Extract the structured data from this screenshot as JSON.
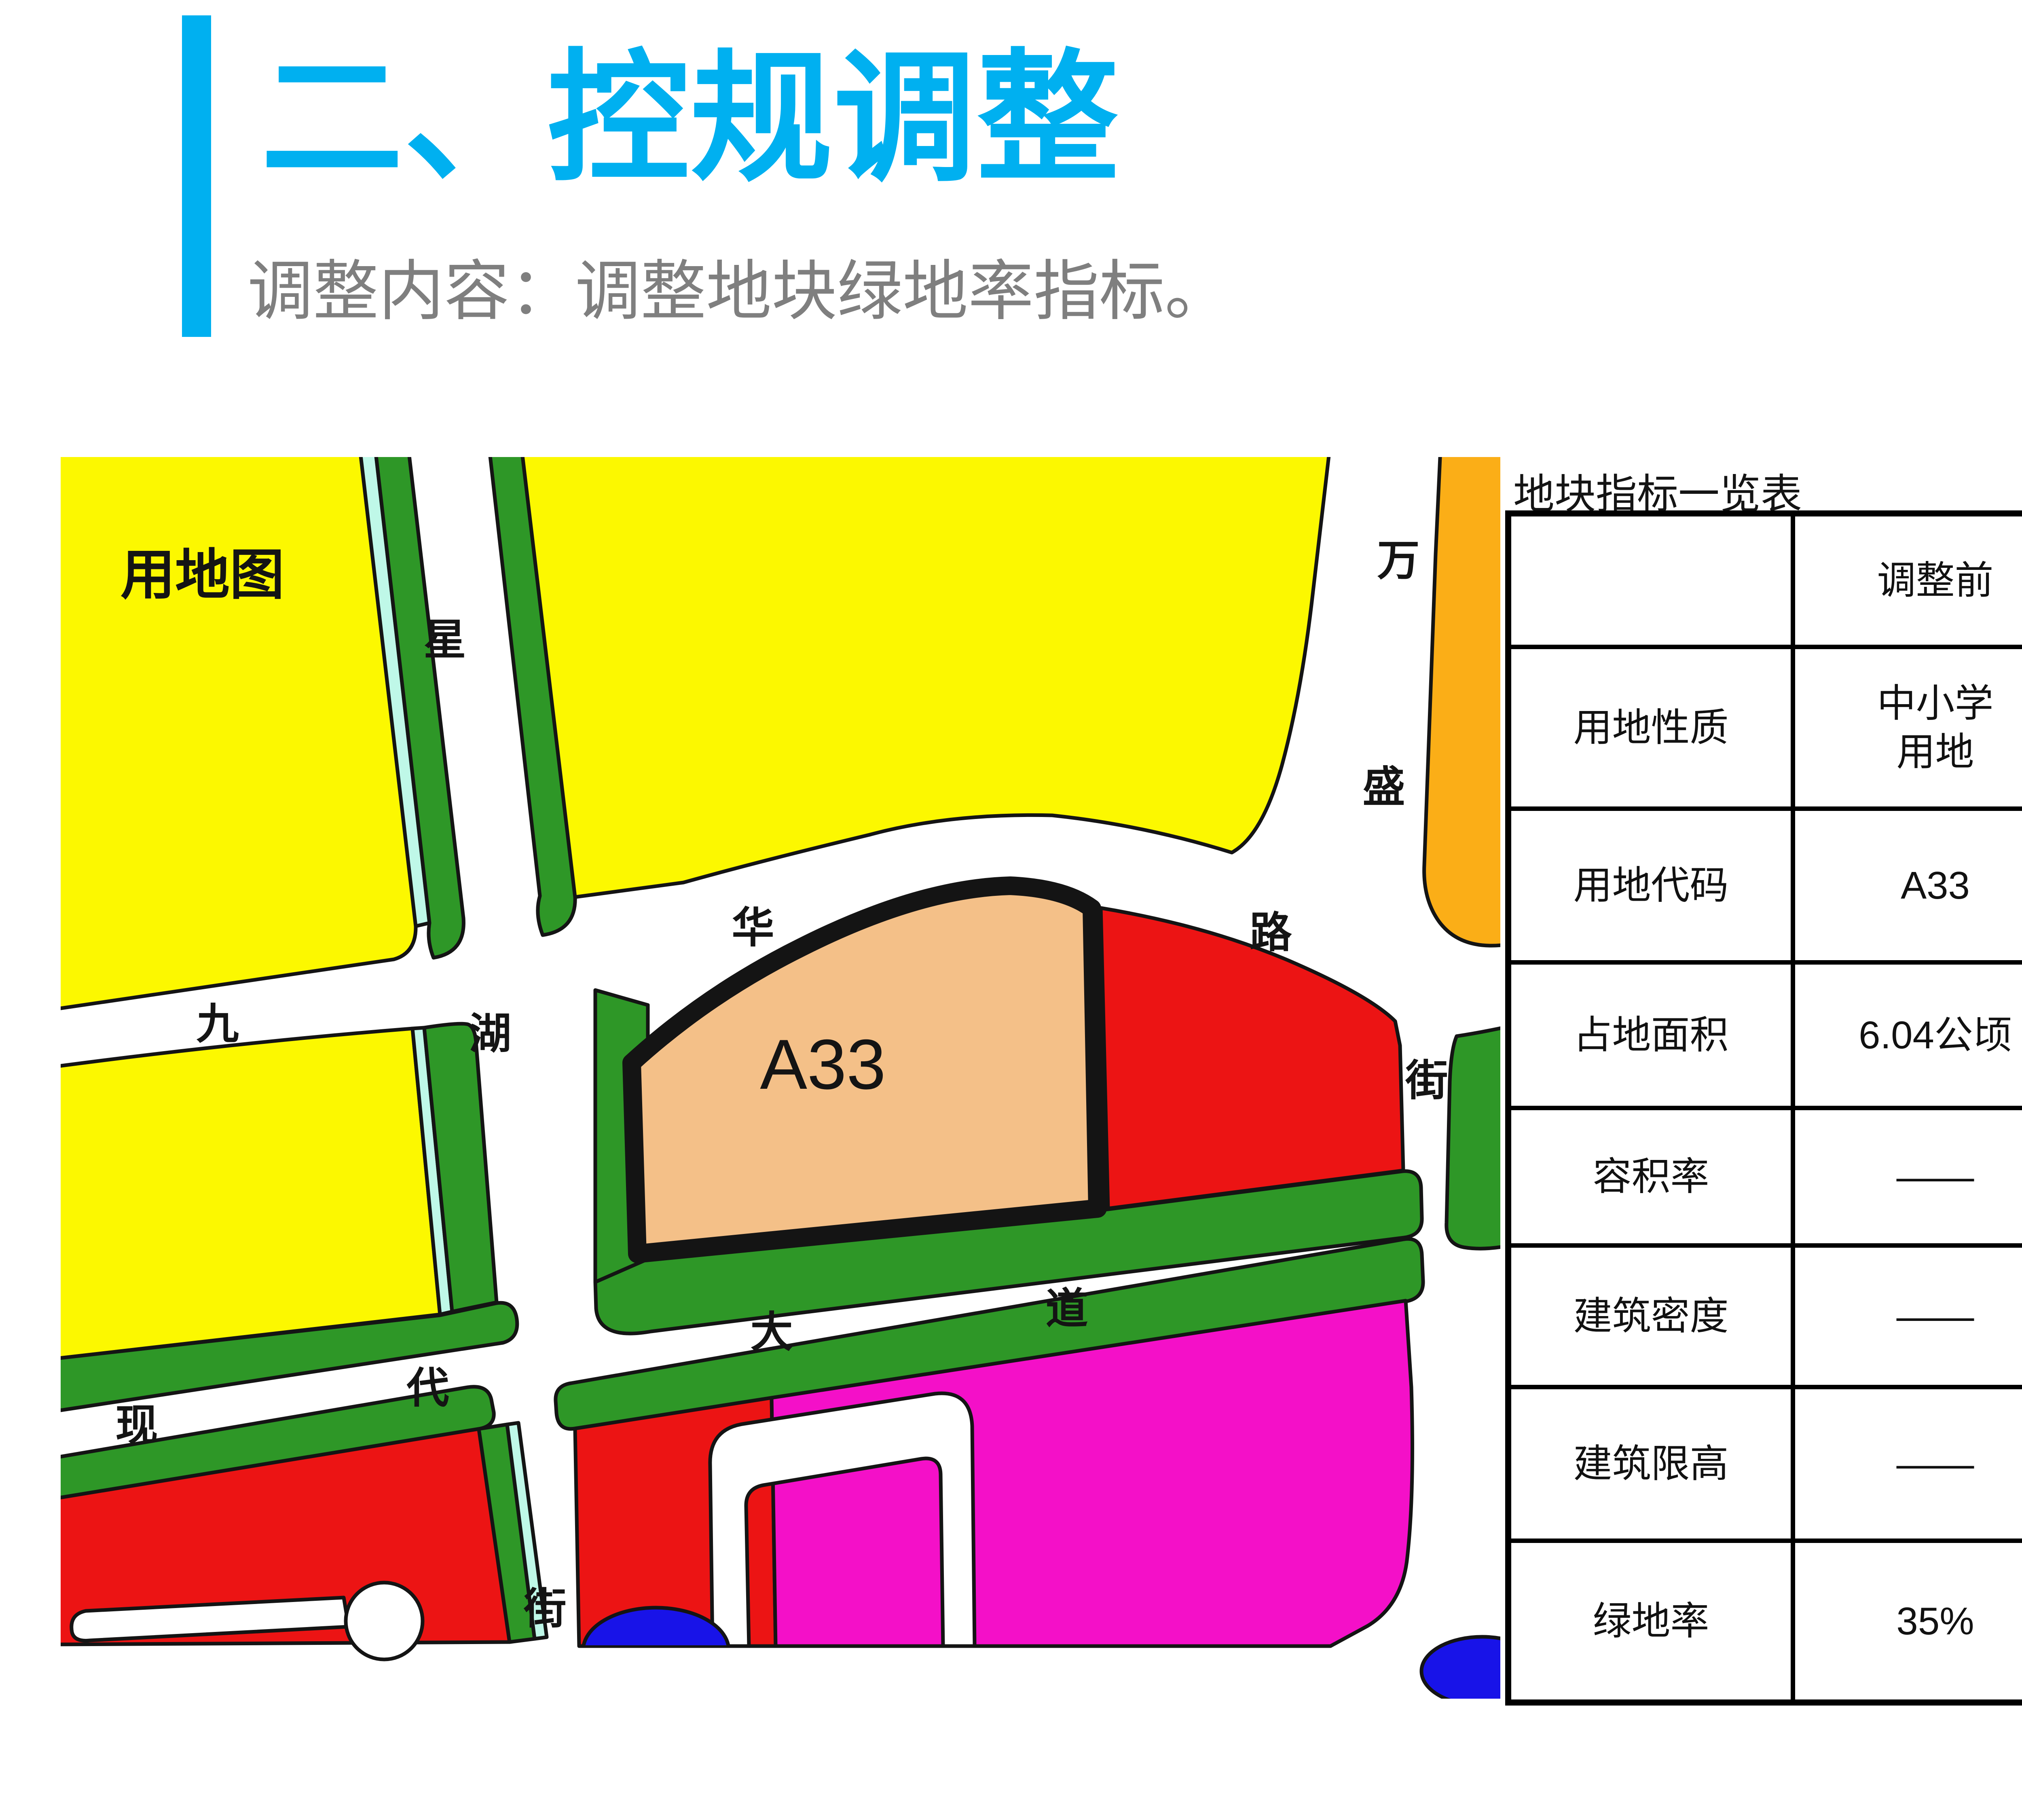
{
  "header": {
    "title": "二、控规调整",
    "subtitle": "调整内容：调整地块绿地率指标。"
  },
  "map": {
    "corner_label": "用地图",
    "parcel_label": "A33",
    "labels": {
      "xing": "星",
      "wan": "万",
      "sheng": "盛",
      "lu": "路",
      "jie_right": "街",
      "jiu": "九",
      "hu": "湖",
      "hua": "华",
      "xian": "现",
      "dai": "代",
      "da": "大",
      "dao": "道",
      "jie_bottom": "街"
    }
  },
  "table": {
    "title": "地块指标一览表",
    "columns": [
      "",
      "调整前",
      "调整后"
    ],
    "rows": [
      {
        "label": "用地性质",
        "before": "中小学\n用地",
        "after": "中小学\n用地"
      },
      {
        "label": "用地代码",
        "before": "A33",
        "after": "A33"
      },
      {
        "label": "占地面积",
        "before": "6.04公顷",
        "after": "6.04公顷"
      },
      {
        "label": "容积率",
        "before": "——",
        "after": "——"
      },
      {
        "label": "建筑密度",
        "before": "——",
        "after": "——"
      },
      {
        "label": "建筑限高",
        "before": "——",
        "after": "——"
      },
      {
        "label": "绿地率",
        "before": "35%",
        "after": "20%"
      }
    ]
  },
  "colors": {
    "accent": "#00B0F0",
    "subtitle_gray": "#7F7F7F",
    "highlight_red": "#FF0000",
    "table_border": "#000000",
    "map_yellow": "#FCF800",
    "map_green": "#2E9727",
    "map_cyan": "#BFF8E8",
    "map_orange": "#FBAE17",
    "map_red": "#EC1414",
    "map_magenta": "#F410C8",
    "map_peach": "#F4C088",
    "map_blue": "#1813E8"
  }
}
